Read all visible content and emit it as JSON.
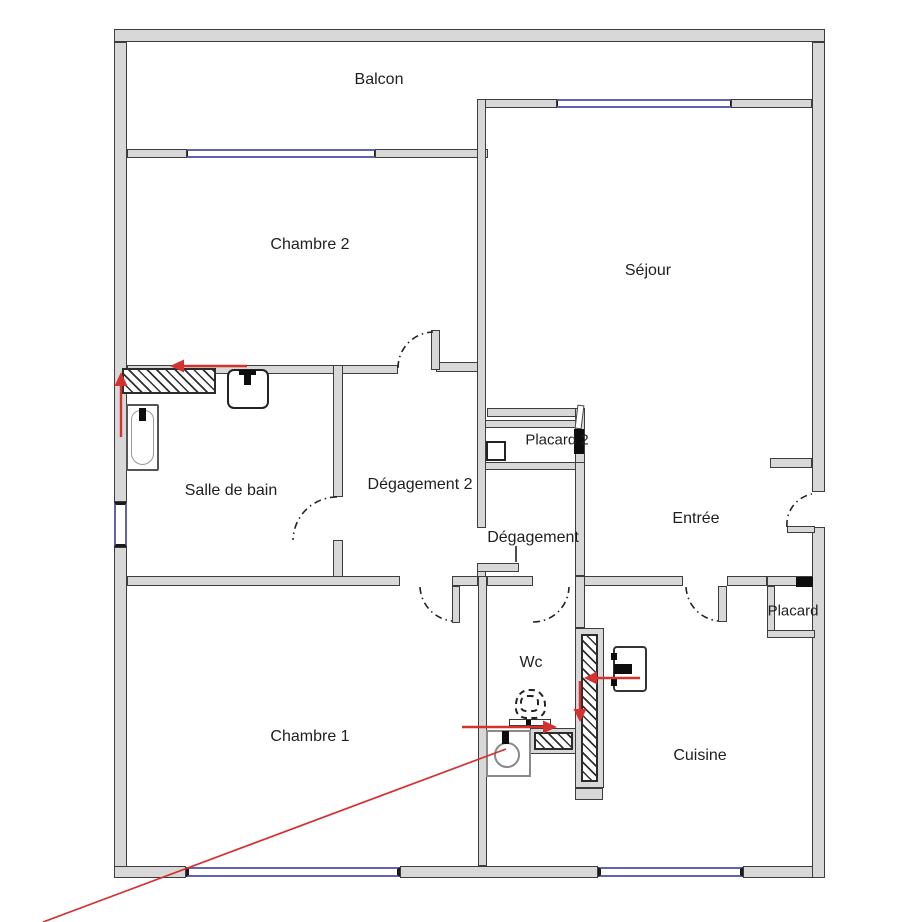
{
  "figure_type": "floor-plan",
  "colors": {
    "wall-fill": "#d8d8d8",
    "wall-line": "#3d3d3d",
    "window-blue": "#6262b0",
    "red": "#d3322f",
    "text": "#1f1f1f",
    "hatch-line": "#2f2f2f",
    "bg": "#ffffff"
  },
  "rooms": [
    {
      "id": "balcon",
      "name": "Balcon"
    },
    {
      "id": "chambre2",
      "name": "Chambre 2"
    },
    {
      "id": "sejour",
      "name": "Séjour"
    },
    {
      "id": "salle-de-bain",
      "name": "Salle de bain"
    },
    {
      "id": "degagement2",
      "name": "Dégagement 2"
    },
    {
      "id": "placard2",
      "name": "Placard 2"
    },
    {
      "id": "degagement",
      "name": "Dégagement"
    },
    {
      "id": "entree",
      "name": "Entrée"
    },
    {
      "id": "wc",
      "name": "Wc"
    },
    {
      "id": "chambre1",
      "name": "Chambre 1"
    },
    {
      "id": "cuisine",
      "name": "Cuisine"
    },
    {
      "id": "placard",
      "name": "Placard"
    }
  ],
  "fixtures": [
    "bathtub",
    "washbasin",
    "toilet",
    "washing-machine",
    "kitchen-sink",
    "closet-shelf"
  ],
  "annotations": {
    "color": "#d3322f",
    "items": [
      "arrow-left-bathroom-wall",
      "arrow-up-bathroom-wall",
      "arrow-left-kitchen-sink",
      "arrow-down-hatched-wall",
      "arrow-right-wc-wall",
      "diagonal-line-to-washing-machine"
    ]
  }
}
